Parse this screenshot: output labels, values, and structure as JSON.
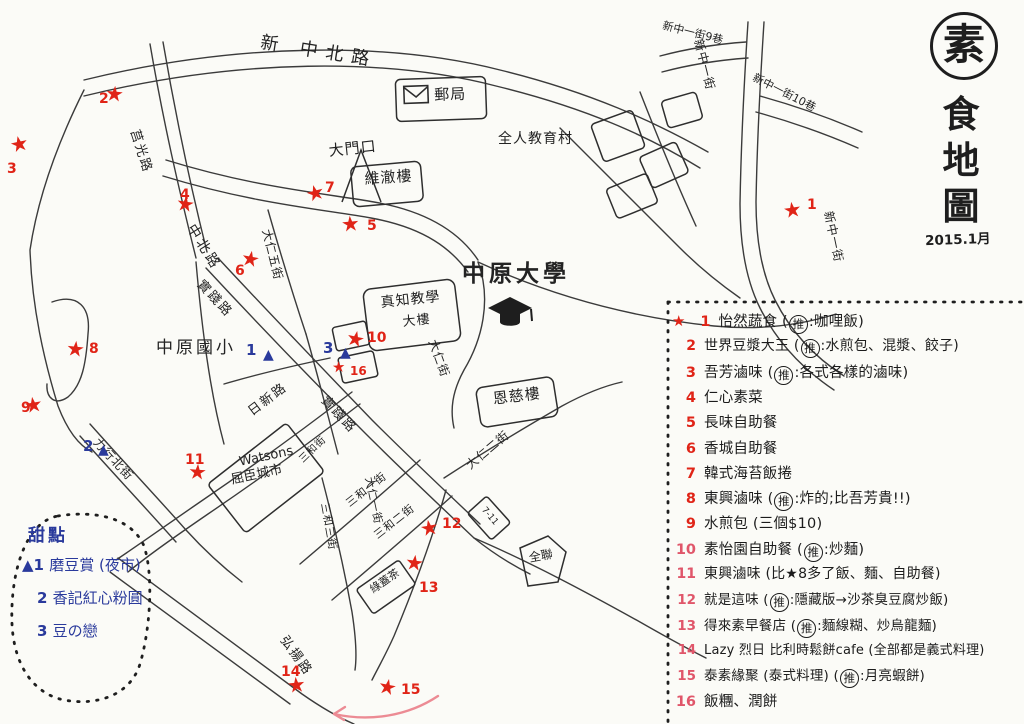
{
  "page": {
    "ink": "#2b2b2b",
    "red": "#e02417",
    "pink_red": "#e0566a",
    "blue": "#2a3a9c",
    "arrow_pink": "#ec8b94",
    "paper": "#fbfbf7"
  },
  "title": {
    "stamp_char": "素",
    "chars": [
      "食",
      "地",
      "圖"
    ],
    "date": "2015.1月"
  },
  "map_labels": [
    {
      "text": "新 中北路",
      "x": 262,
      "y": 34,
      "rot": 9,
      "size": 18,
      "ls": 8
    },
    {
      "text": "莒光路",
      "x": 140,
      "y": 128,
      "rot": 72,
      "size": 13,
      "ls": 2
    },
    {
      "text": "中北路",
      "x": 196,
      "y": 222,
      "rot": 58,
      "size": 14,
      "ls": 3
    },
    {
      "text": "實踐路",
      "x": 204,
      "y": 278,
      "rot": 47,
      "size": 13,
      "ls": 2
    },
    {
      "text": "實踐路",
      "x": 328,
      "y": 394,
      "rot": 47,
      "size": 13,
      "ls": 2
    },
    {
      "text": "大仁五街",
      "x": 272,
      "y": 228,
      "rot": 76,
      "size": 12,
      "ls": 1
    },
    {
      "text": "大仁街",
      "x": 438,
      "y": 338,
      "rot": 70,
      "size": 12,
      "ls": 1
    },
    {
      "text": "大仁一街",
      "x": 374,
      "y": 476,
      "rot": 78,
      "size": 11,
      "ls": 1
    },
    {
      "text": "大仁二街",
      "x": 464,
      "y": 462,
      "rot": -40,
      "size": 12,
      "ls": 1
    },
    {
      "text": "日新路",
      "x": 246,
      "y": 408,
      "rot": -37,
      "size": 13,
      "ls": 2
    },
    {
      "text": "力行北街",
      "x": 100,
      "y": 436,
      "rot": 47,
      "size": 12,
      "ls": 1
    },
    {
      "text": "三和街",
      "x": 298,
      "y": 458,
      "rot": -44,
      "size": 10,
      "ls": 1
    },
    {
      "text": "三和一街",
      "x": 344,
      "y": 500,
      "rot": -38,
      "size": 11,
      "ls": 1
    },
    {
      "text": "三和二街",
      "x": 372,
      "y": 532,
      "rot": -38,
      "size": 11,
      "ls": 1
    },
    {
      "text": "三和三街",
      "x": 330,
      "y": 502,
      "rot": 80,
      "size": 11,
      "ls": 1
    },
    {
      "text": "弘揚路",
      "x": 288,
      "y": 634,
      "rot": 54,
      "size": 13,
      "ls": 2
    },
    {
      "text": "中原國小",
      "x": 156,
      "y": 340,
      "rot": 0,
      "size": 17,
      "ls": 3
    },
    {
      "text": "中原大學",
      "x": 462,
      "y": 262,
      "rot": 0,
      "size": 23,
      "ls": 4,
      "bold": true
    },
    {
      "text": "全人教育村",
      "x": 498,
      "y": 132,
      "rot": 0,
      "size": 14,
      "ls": 1
    },
    {
      "text": "大門口",
      "x": 328,
      "y": 144,
      "rot": -6,
      "size": 15,
      "ls": 1
    },
    {
      "text": "維澈樓",
      "x": 364,
      "y": 172,
      "rot": -4,
      "size": 15,
      "ls": 1
    },
    {
      "text": "真知教學",
      "x": 380,
      "y": 296,
      "rot": -6,
      "size": 14,
      "ls": 1
    },
    {
      "text": "大樓",
      "x": 402,
      "y": 316,
      "rot": -6,
      "size": 13,
      "ls": 1
    },
    {
      "text": "恩慈樓",
      "x": 492,
      "y": 392,
      "rot": -7,
      "size": 15,
      "ls": 1
    },
    {
      "text": "郵局",
      "x": 434,
      "y": 88,
      "rot": -2,
      "size": 15,
      "ls": 1
    },
    {
      "text": "Watsons",
      "x": 238,
      "y": 456,
      "rot": -12,
      "size": 13,
      "ls": 0
    },
    {
      "text": "屈臣城市",
      "x": 230,
      "y": 474,
      "rot": -12,
      "size": 13,
      "ls": 0
    },
    {
      "text": "綠蓋茶",
      "x": 368,
      "y": 586,
      "rot": -35,
      "size": 11,
      "ls": 0
    },
    {
      "text": "全聯",
      "x": 528,
      "y": 552,
      "rot": -10,
      "size": 12,
      "ls": 0
    },
    {
      "text": "7-11",
      "x": 486,
      "y": 506,
      "rot": 50,
      "size": 9,
      "ls": 0
    },
    {
      "text": "新中一街9巷",
      "x": 664,
      "y": 20,
      "rot": 14,
      "size": 11,
      "ls": 0
    },
    {
      "text": "新中一街",
      "x": 704,
      "y": 38,
      "rot": 76,
      "size": 12,
      "ls": 1
    },
    {
      "text": "新中一街10巷",
      "x": 756,
      "y": 72,
      "rot": 27,
      "size": 11,
      "ls": 0
    },
    {
      "text": "新中一街",
      "x": 834,
      "y": 210,
      "rot": 78,
      "size": 12,
      "ls": 1
    }
  ],
  "stars": [
    {
      "n": "1",
      "sx": 793,
      "sy": 212,
      "nx": 807,
      "ny": 198
    },
    {
      "n": "2",
      "sx": 115,
      "sy": 96,
      "nx": 99,
      "ny": 92
    },
    {
      "n": "3",
      "sx": 20,
      "sy": 146,
      "nx": 7,
      "ny": 162
    },
    {
      "n": "4",
      "sx": 186,
      "sy": 206,
      "nx": 180,
      "ny": 188
    },
    {
      "n": "5",
      "sx": 351,
      "sy": 226,
      "nx": 367,
      "ny": 219
    },
    {
      "n": "6",
      "sx": 251,
      "sy": 261,
      "nx": 235,
      "ny": 264
    },
    {
      "n": "7",
      "sx": 316,
      "sy": 195,
      "nx": 325,
      "ny": 181
    },
    {
      "n": "8",
      "sx": 76,
      "sy": 351,
      "nx": 89,
      "ny": 342
    },
    {
      "n": "9",
      "sx": 34,
      "sy": 407,
      "nx": 21,
      "ny": 401
    },
    {
      "n": "10",
      "sx": 356,
      "sy": 341,
      "nx": 367,
      "ny": 331
    },
    {
      "n": "11",
      "sx": 198,
      "sy": 474,
      "nx": 185,
      "ny": 453
    },
    {
      "n": "12",
      "sx": 430,
      "sy": 530,
      "nx": 442,
      "ny": 517
    },
    {
      "n": "13",
      "sx": 415,
      "sy": 565,
      "nx": 419,
      "ny": 581
    },
    {
      "n": "14",
      "sx": 297,
      "sy": 687,
      "nx": 281,
      "ny": 665
    },
    {
      "n": "15",
      "sx": 388,
      "sy": 689,
      "nx": 401,
      "ny": 683
    },
    {
      "n": "16",
      "sx": 339,
      "sy": 369,
      "nx": 350,
      "ny": 365,
      "small": true
    }
  ],
  "dessert_markers": [
    {
      "n": "1",
      "nx": 246,
      "ny": 343,
      "tx": 263,
      "ty": 348
    },
    {
      "n": "2",
      "nx": 83,
      "ny": 439,
      "tx": 98,
      "ny2": 0,
      "ty": 443
    },
    {
      "n": "3",
      "nx": 323,
      "ny": 341,
      "tx": 340,
      "ty": 346
    }
  ],
  "legend": {
    "items": [
      {
        "num": "1",
        "star": true,
        "size": 14.5,
        "parts": [
          {
            "t": "怡然蔬食 ("
          },
          {
            "c": "推"
          },
          {
            "t": ":咖哩飯)"
          }
        ]
      },
      {
        "num": "2",
        "size": 14,
        "parts": [
          {
            "t": "世界豆漿大王 ("
          },
          {
            "c": "推"
          },
          {
            "t": ":水煎包、混漿、餃子)"
          }
        ]
      },
      {
        "num": "3",
        "size": 14.5,
        "parts": [
          {
            "t": "吾芳滷味 ("
          },
          {
            "c": "推"
          },
          {
            "t": ":各式各樣的滷味)"
          }
        ]
      },
      {
        "num": "4",
        "size": 14.5,
        "parts": [
          {
            "t": "仁心素菜"
          }
        ]
      },
      {
        "num": "5",
        "size": 14.5,
        "parts": [
          {
            "t": "長味自助餐"
          }
        ]
      },
      {
        "num": "6",
        "size": 14.5,
        "parts": [
          {
            "t": "香城自助餐"
          }
        ]
      },
      {
        "num": "7",
        "size": 14.5,
        "parts": [
          {
            "t": "韓式海苔飯捲"
          }
        ]
      },
      {
        "num": "8",
        "size": 14.5,
        "parts": [
          {
            "t": "東興滷味 ("
          },
          {
            "c": "推"
          },
          {
            "t": ":炸的;比吾芳貴!!)"
          }
        ]
      },
      {
        "num": "9",
        "size": 14.5,
        "parts": [
          {
            "t": "水煎包 (三個$10)"
          }
        ]
      },
      {
        "num": "10",
        "size": 14.5,
        "parts": [
          {
            "t": "素怡園自助餐 ("
          },
          {
            "c": "推"
          },
          {
            "t": ":炒麵)"
          }
        ]
      },
      {
        "num": "11",
        "size": 14,
        "parts": [
          {
            "t": "東興滷味 (比★8多了飯、麵、自助餐)"
          }
        ]
      },
      {
        "num": "12",
        "size": 13.5,
        "parts": [
          {
            "t": "就是這味 ("
          },
          {
            "c": "推"
          },
          {
            "t": ":隱藏版→沙茶臭豆腐炒飯)"
          }
        ]
      },
      {
        "num": "13",
        "size": 13.5,
        "parts": [
          {
            "t": "得來素早餐店 ("
          },
          {
            "c": "推"
          },
          {
            "t": ":麵線糊、炒烏龍麵)"
          }
        ]
      },
      {
        "num": "14",
        "size": 13,
        "parts": [
          {
            "t": "Lazy 烈日 比利時鬆餅cafe (全部都是義式料理)"
          }
        ]
      },
      {
        "num": "15",
        "size": 13.5,
        "parts": [
          {
            "t": "泰素緣聚 (泰式料理) ("
          },
          {
            "c": "推"
          },
          {
            "t": ":月亮蝦餅)"
          }
        ]
      },
      {
        "num": "16",
        "size": 14.5,
        "parts": [
          {
            "t": "飯糰、潤餅"
          }
        ]
      }
    ]
  },
  "dessert_panel": {
    "title": "甜點",
    "items": [
      {
        "num": "1",
        "tri": true,
        "text": "磨豆賞 (夜市)"
      },
      {
        "num": "2",
        "tri": false,
        "text": "香記紅心粉圓"
      },
      {
        "num": "3",
        "tri": false,
        "text": "豆の戀"
      }
    ]
  }
}
